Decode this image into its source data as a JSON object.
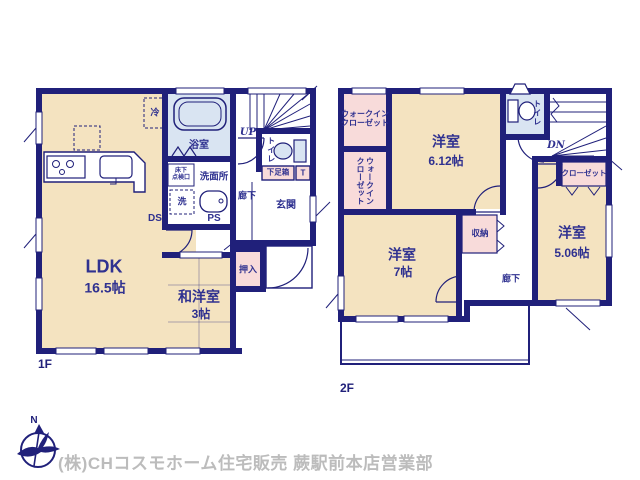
{
  "meta": {
    "type": "floor-plan",
    "floor1_tag": "1F",
    "floor2_tag": "2F"
  },
  "colors": {
    "wall": "#20207a",
    "room_beige": "#f4e3c0",
    "wet_blue": "#d9e4f2",
    "closet_pink": "#f8dbda",
    "label_navy": "#2f3190",
    "footer_gray": "#bcbcbc"
  },
  "floor1": {
    "label": "1F",
    "ldk": {
      "name": "LDK",
      "size": "16.5帖"
    },
    "washitsu": {
      "name": "和洋室",
      "size": "3帖"
    },
    "oshiire": "押入",
    "genkan": "玄関",
    "rouka": "廊下",
    "getabako": "下足箱",
    "toilet_cabinet": "T",
    "toilet": "トイレ",
    "stairs": "UP",
    "bath": "浴室",
    "senmenjo": "洗面所",
    "inspection_hatch": "床下\n点検口",
    "washer": "洗",
    "fridge": "冷",
    "ds": "DS",
    "ps": "PS"
  },
  "floor2": {
    "label": "2F",
    "wic_upper": "ウォークイン\nクローゼット",
    "wic_lower": "ウォークイン\nクローゼット",
    "room_612": {
      "name": "洋室",
      "size": "6.12帖"
    },
    "toilet": "トイレ",
    "stairs": "DN",
    "closet": "クローゼット",
    "room_506": {
      "name": "洋室",
      "size": "5.06帖"
    },
    "storage": "収納",
    "room_7": {
      "name": "洋室",
      "size": "7帖"
    },
    "rouka": "廊下"
  },
  "footer": {
    "company": "(株)CHコスモホーム住宅販売 蕨駅前本店営業部",
    "compass_n": "N"
  }
}
